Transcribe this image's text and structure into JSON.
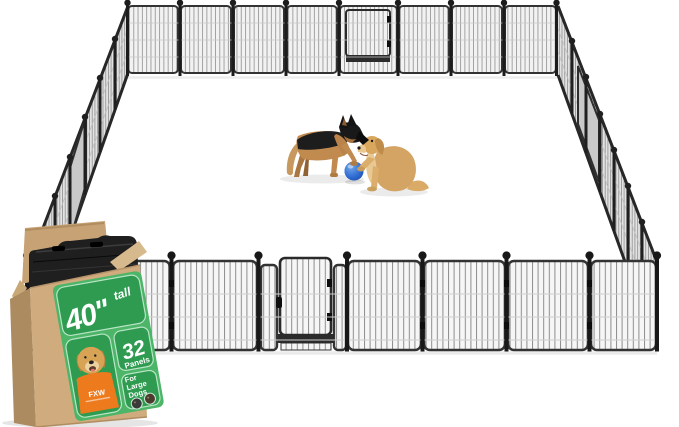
{
  "product": {
    "label": {
      "height_value": "40\"",
      "height_suffix": "tall",
      "panel_count": "32",
      "panel_word": "Panels",
      "audience_lines": [
        "For",
        "Large",
        "Dogs"
      ],
      "brand": "FXW"
    }
  },
  "colors": {
    "label_green": "#4db568",
    "label_green_dark": "#2e9b50",
    "label_trim": "#bde6c9",
    "cardboard_front": "#cfab7e",
    "cardboard_side": "#ad8b60",
    "fence_metal": "#232323",
    "ball_blue": "#2c66c9",
    "shirt_orange": "#ee7a1e"
  }
}
